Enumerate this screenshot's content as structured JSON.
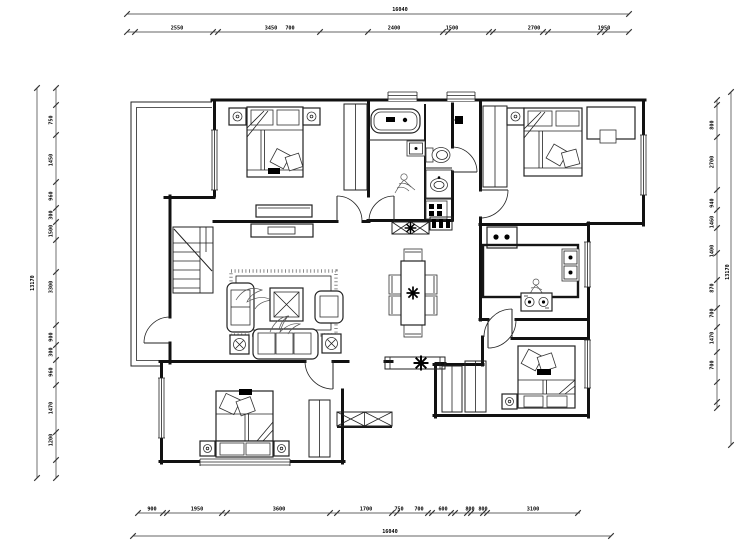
{
  "drawing": {
    "type": "architectural-floor-plan",
    "style": "CAD black-line plan",
    "units": "mm",
    "ink_color": "#1a1a1a",
    "dim_color": "#333333"
  },
  "furniture_icons": [
    "double-bed-icon",
    "nightstand-icon",
    "wardrobe-icon",
    "bathtub-icon",
    "toilet-icon",
    "washbasin-icon",
    "washer-icon",
    "sofa-icon",
    "armchair-icon",
    "coffee-table-icon",
    "rug-icon",
    "dining-table-icon",
    "chair-icon",
    "plant-icon",
    "fridge-icon",
    "sink-icon",
    "cooktop-icon",
    "desk-icon",
    "stairs-icon",
    "shoe-cabinet-icon",
    "tv-cabinet-icon",
    "person-figure-icon",
    "door-swing-icon",
    "window-icon"
  ],
  "dimensions": {
    "top": {
      "overall": {
        "orient": "h",
        "a1": 127,
        "a2": 629,
        "pos": 14,
        "label": "16040",
        "lx": 400,
        "ly": 11
      },
      "segments": {
        "orient": "h",
        "a1": 127,
        "a2": 629,
        "pos": 32,
        "ticks": [
          127,
          135,
          213,
          218,
          320,
          368,
          443,
          448,
          489,
          493,
          543,
          548,
          600,
          605,
          629
        ],
        "labels": [
          {
            "p": 177,
            "v": "2550"
          },
          {
            "p": 271,
            "v": "3450"
          },
          {
            "p": 290,
            "v": "700"
          },
          {
            "p": 394,
            "v": "2400"
          },
          {
            "p": 452,
            "v": "1500"
          },
          {
            "p": 534,
            "v": "2700"
          },
          {
            "p": 604,
            "v": "1950"
          }
        ]
      }
    },
    "bottom": {
      "overall": {
        "orient": "h",
        "a1": 133,
        "a2": 611,
        "pos": 536,
        "label": "16040",
        "lx": 390,
        "ly": 533
      },
      "segments": {
        "orient": "h",
        "a1": 138,
        "a2": 580,
        "pos": 513,
        "ticks": [
          138,
          163,
          167,
          222,
          227,
          330,
          337,
          392,
          397,
          428,
          432,
          451,
          455,
          467,
          471,
          483,
          487,
          578
        ],
        "labels": [
          {
            "p": 152,
            "v": "900"
          },
          {
            "p": 197,
            "v": "1950"
          },
          {
            "p": 279,
            "v": "3600"
          },
          {
            "p": 366,
            "v": "1700"
          },
          {
            "p": 399,
            "v": "750"
          },
          {
            "p": 419,
            "v": "700"
          },
          {
            "p": 443,
            "v": "600"
          },
          {
            "p": 470,
            "v": "800"
          },
          {
            "p": 483,
            "v": "800"
          },
          {
            "p": 533,
            "v": "3100"
          }
        ]
      }
    },
    "left": {
      "overall": {
        "orient": "v",
        "a1": 88,
        "a2": 478,
        "pos": 37,
        "label": "13170",
        "lx": 34,
        "ly": 283
      },
      "segments": {
        "orient": "v",
        "a1": 88,
        "a2": 478,
        "pos": 56,
        "ticks": [
          88,
          105,
          135,
          182,
          208,
          222,
          240,
          272,
          325,
          345,
          360,
          385,
          432,
          460,
          478
        ],
        "labels": [
          {
            "p": 120,
            "v": "750"
          },
          {
            "p": 160,
            "v": "1450"
          },
          {
            "p": 196,
            "v": "960"
          },
          {
            "p": 215,
            "v": "300"
          },
          {
            "p": 231,
            "v": "1500"
          },
          {
            "p": 287,
            "v": "3300"
          },
          {
            "p": 337,
            "v": "900"
          },
          {
            "p": 352,
            "v": "300"
          },
          {
            "p": 372,
            "v": "960"
          },
          {
            "p": 408,
            "v": "1470"
          },
          {
            "p": 440,
            "v": "1200"
          }
        ]
      }
    },
    "right": {
      "overall": {
        "orient": "v",
        "a1": 92,
        "a2": 445,
        "pos": 731,
        "label": "13170",
        "lx": 729,
        "ly": 272
      },
      "segments": {
        "orient": "v",
        "a1": 100,
        "a2": 408,
        "pos": 717,
        "ticks": [
          100,
          105,
          137,
          190,
          210,
          228,
          253,
          280,
          308,
          327,
          352,
          382,
          402,
          408
        ],
        "labels": [
          {
            "p": 125,
            "v": "800"
          },
          {
            "p": 162,
            "v": "2700"
          },
          {
            "p": 203,
            "v": "940"
          },
          {
            "p": 222,
            "v": "1460"
          },
          {
            "p": 251,
            "v": "1400"
          },
          {
            "p": 288,
            "v": "870"
          },
          {
            "p": 313,
            "v": "700"
          },
          {
            "p": 338,
            "v": "1470"
          },
          {
            "p": 365,
            "v": "700"
          }
        ]
      }
    }
  }
}
